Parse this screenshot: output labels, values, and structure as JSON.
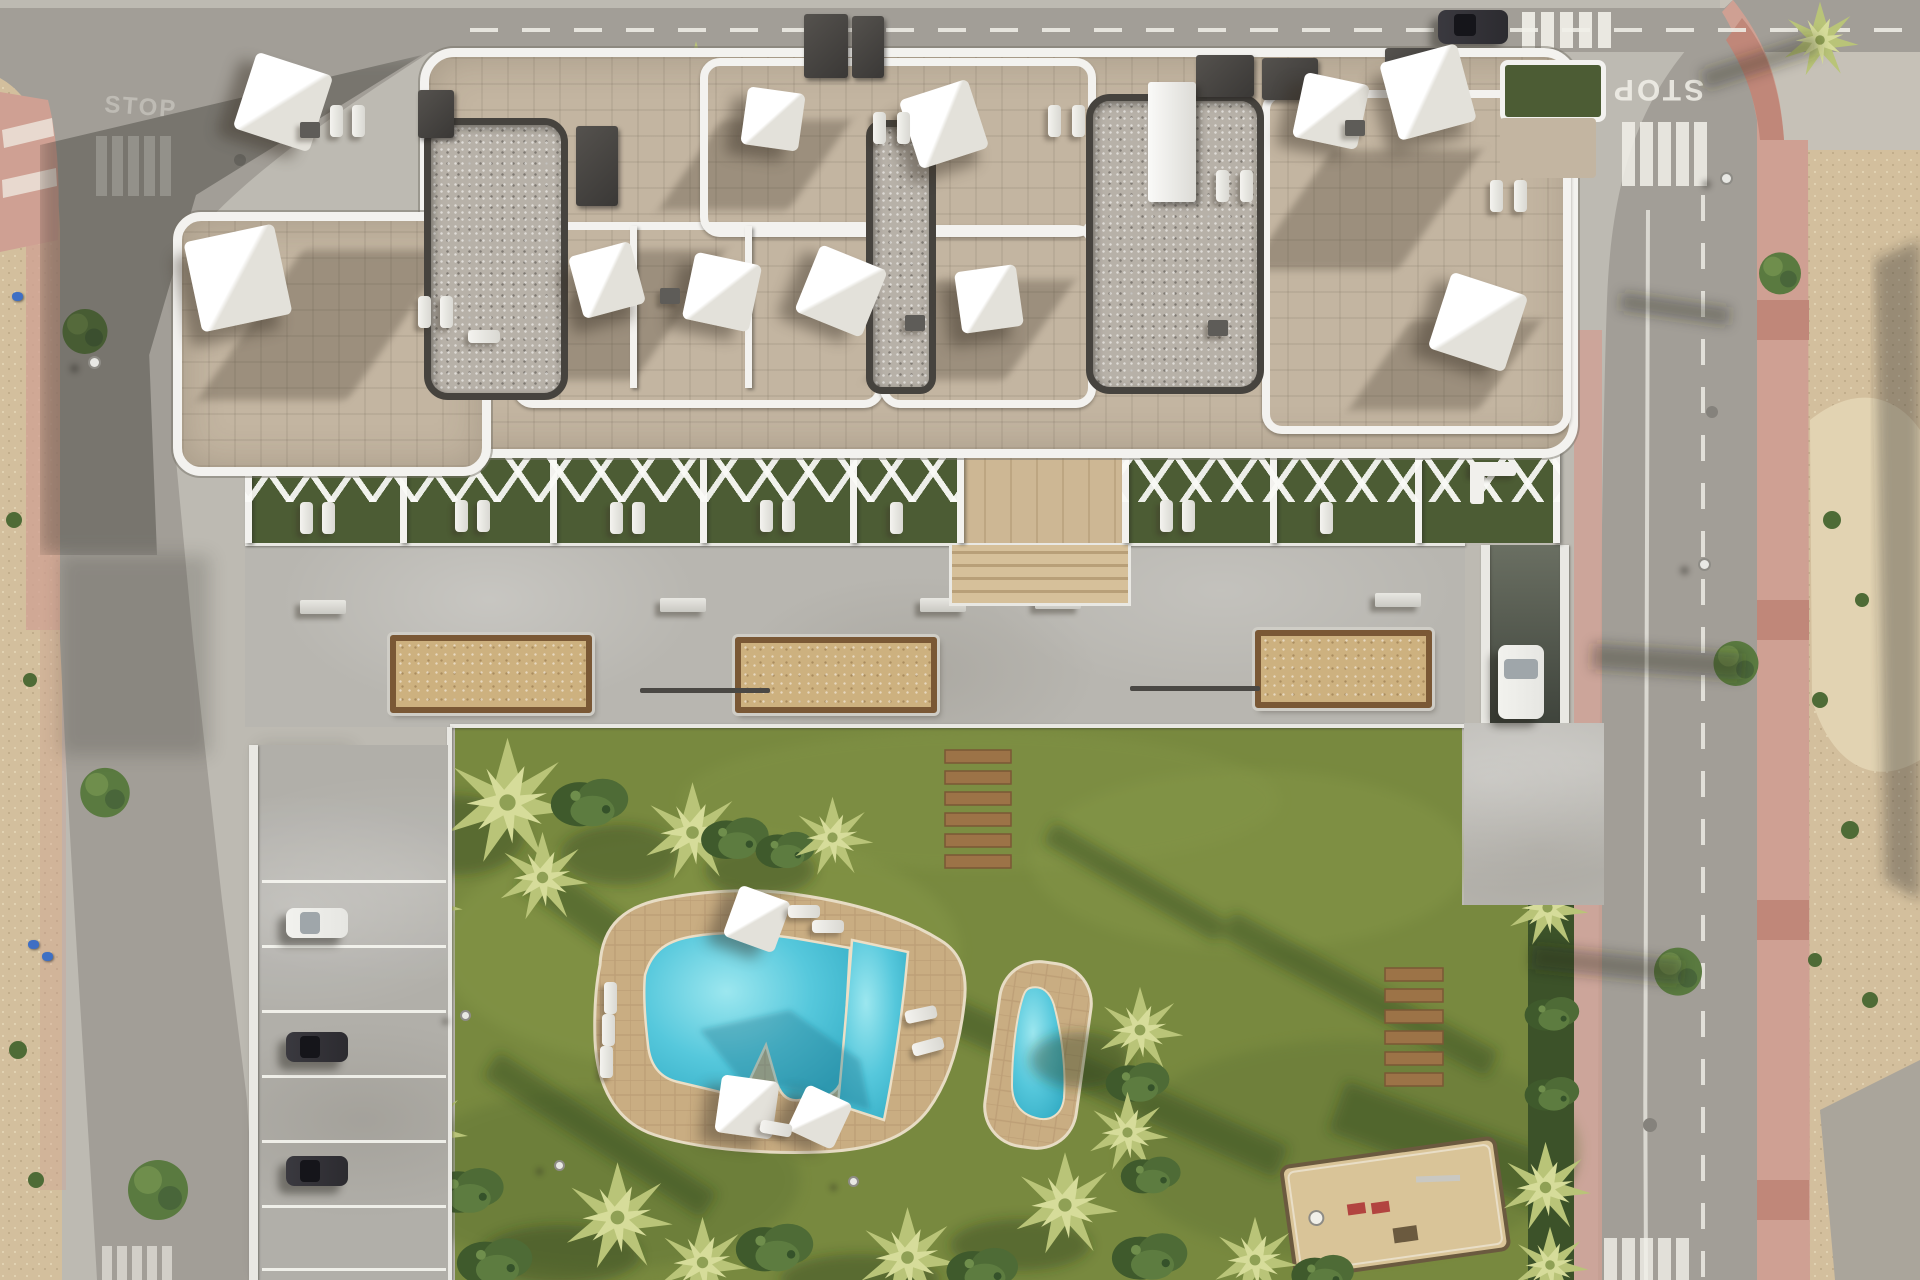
{
  "scene": {
    "kind": "aerial 3D architectural render",
    "description": "Top-down view of a white residential apartment complex with rooftop terraces, white shade sails and sun loungers, a gray communal plaza with three sand planters, a landscaped garden with free-form turquoise pool, secondary plunge pool, wooden sun decks, playground, palm trees, perimeter roads with STOP markings, crosswalks, parked cars and undeveloped dirt lot on the right",
    "width": 1920,
    "height": 1280
  },
  "markings": {
    "stop": "STOP"
  },
  "inventory": {
    "planters": 3,
    "pools": 2,
    "parked_cars_left": 3,
    "car_on_driveway": 1,
    "car_on_top_road": 1,
    "wood_plank_groups": 2,
    "playground": 1,
    "shade_sails_roof": 11,
    "crosswalks": 5
  },
  "palette": {
    "asphalt": "#a29e97",
    "asphalt_dark": "#8a8781",
    "concrete_plaza": "#b8b6b0",
    "concrete_light": "#c7c5bf",
    "curb_white": "#e9e8e3",
    "sidewalk_pink": "#cfa093",
    "sidewalk_pink_deep": "#c08779",
    "dirt_sand": "#d3bf9d",
    "dirt_light": "#e2d3b2",
    "rubble_gray": "#aaa59b",
    "lawn": "#78893f",
    "lawn_dark": "#5f7234",
    "lawn_light": "#8c9e4e",
    "hedge_dark": "#3c5229",
    "palm_light": "#d6dc9a",
    "palm_mid": "#b9c478",
    "palm_core": "#8fa055",
    "planter_sand": "#cdb17f",
    "wood": "#9c7347",
    "wood_dark": "#7a5835",
    "deck_tan": "#c9ad82",
    "deck_grout": "#b3946c",
    "pool_blue": "#56c8dc",
    "pool_blue_light": "#97e4ec",
    "pool_blue_dark": "#2fa7bf",
    "roof_tile": "#c3b5a1",
    "gravel": "#b7b1a8",
    "gravel_frame": "#46433e",
    "roof_dark_box": "#3a3836",
    "white_structure": "#f3f2ef",
    "grass_terrace": "#4c5c34",
    "car_dark": "#2c2b30",
    "car_white": "#e6e6e2",
    "playground_sand": "#d9c498",
    "play_red": "#b24440",
    "marking_white": "#f2f1ea"
  }
}
